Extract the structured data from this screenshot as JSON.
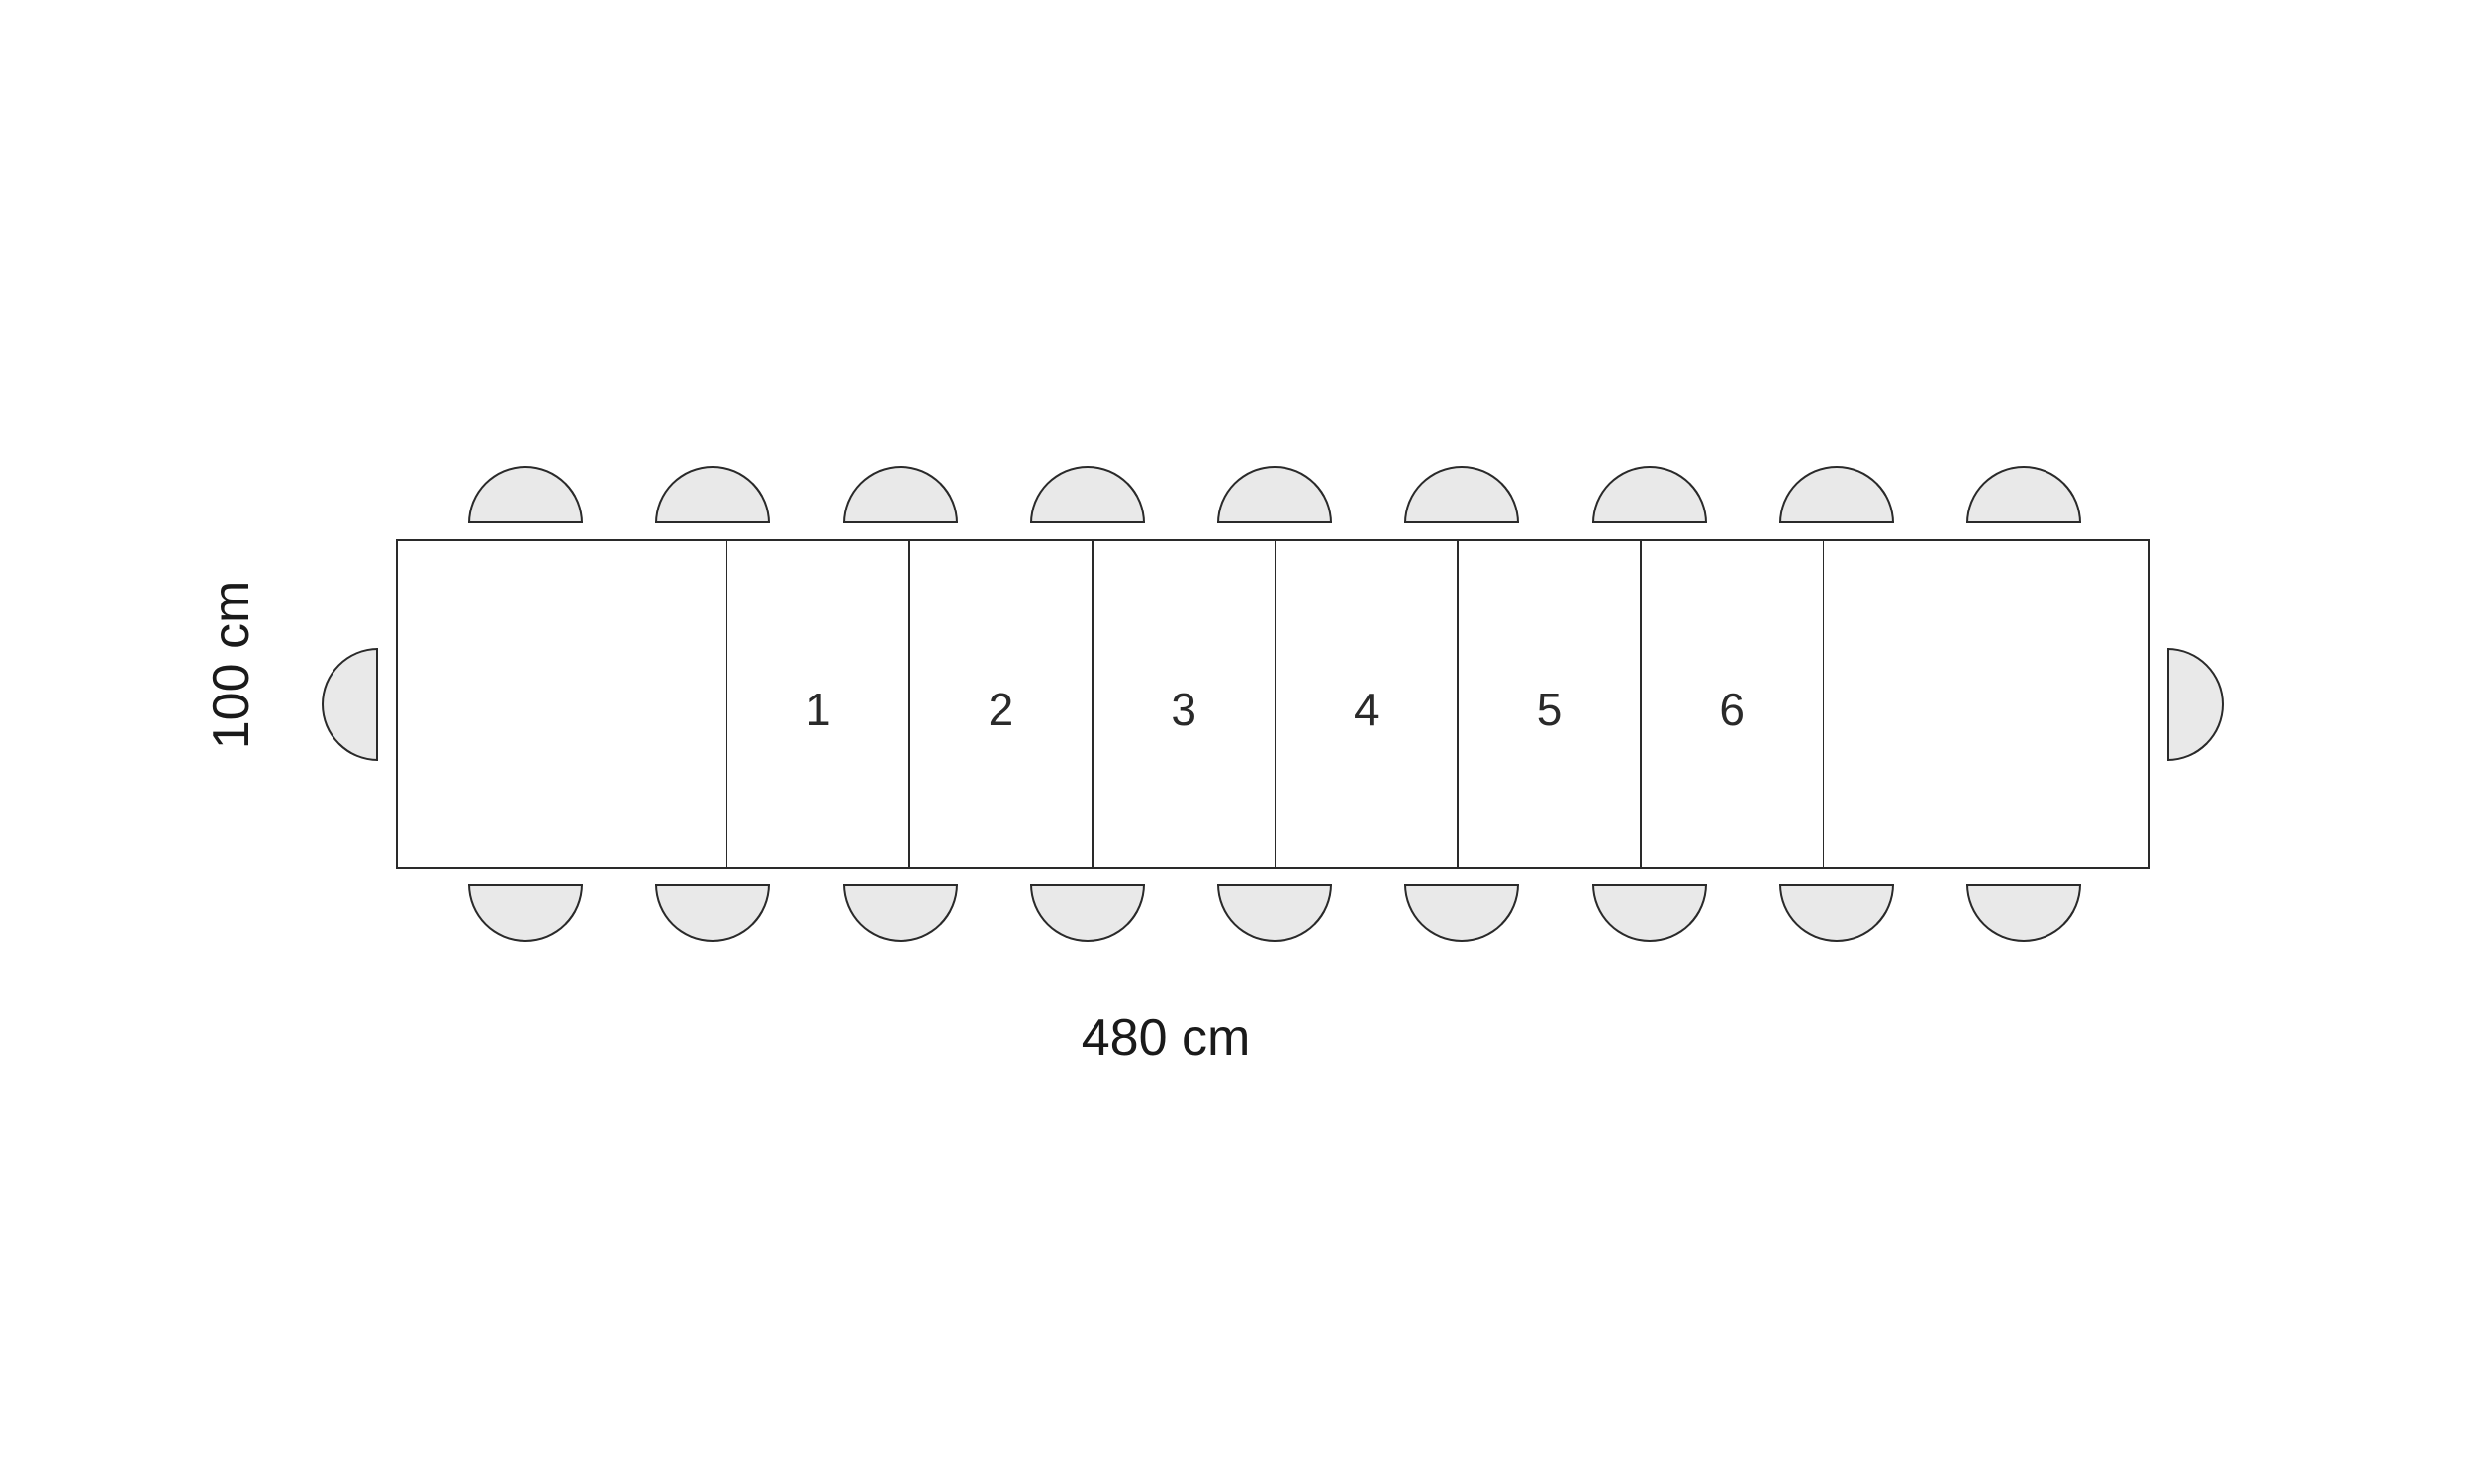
{
  "diagram": {
    "dimensions": {
      "width_label": "480 cm",
      "depth_label": "100 cm"
    },
    "table": {
      "section_labels": [
        "",
        "1",
        "2",
        "3",
        "4",
        "5",
        "6",
        ""
      ],
      "section_widths_cm": [
        90,
        50,
        50,
        50,
        50,
        50,
        50,
        90
      ],
      "total_width_cm": 480,
      "total_depth_cm": 100
    },
    "seats": {
      "top_count": 9,
      "bottom_count": 9,
      "left_count": 1,
      "right_count": 1
    },
    "colors": {
      "line": "#2a2a2a",
      "seat_fill": "#e9e9e9",
      "background": "#ffffff",
      "section_number": "#2a2a2a",
      "dimension_text": "#1a1a1a"
    }
  }
}
